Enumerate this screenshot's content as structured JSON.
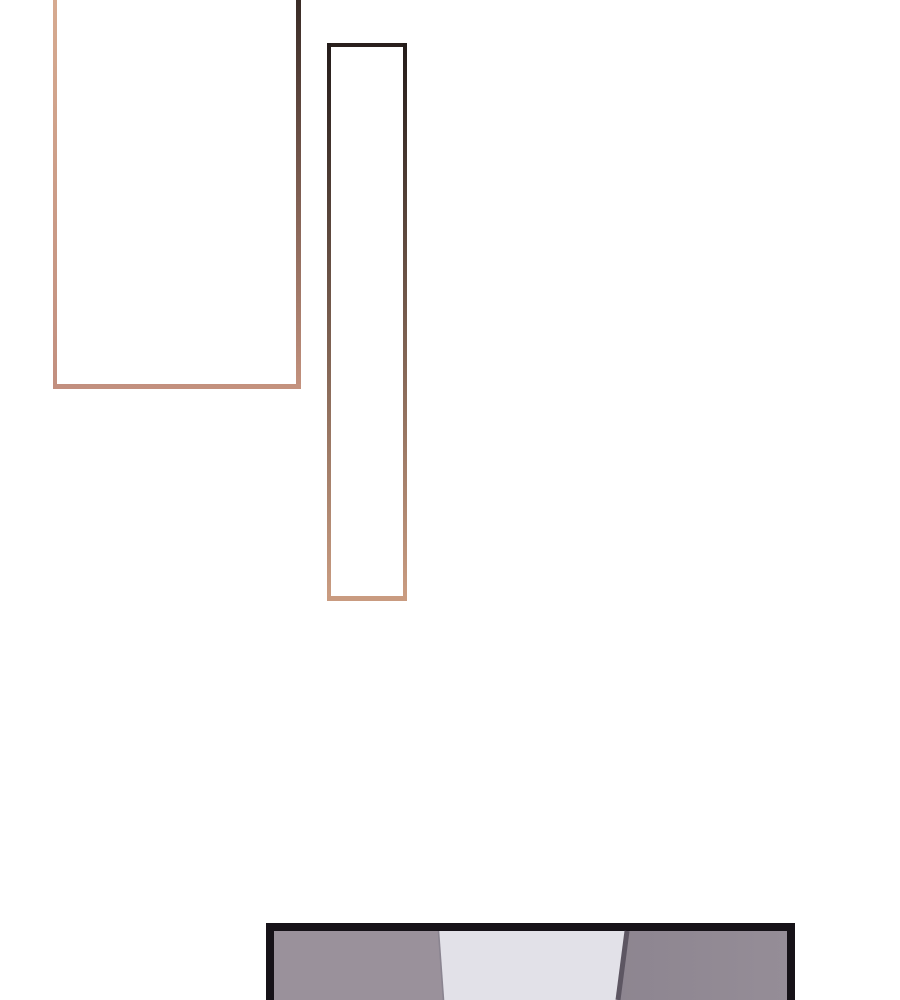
{
  "page": {
    "background": "#ffffff"
  },
  "panel_large": {
    "fill": "#ffffff",
    "border_left_top": "#d6aa90",
    "border_left_bottom": "#c28f7f",
    "border_right_top": "#392b26",
    "border_right_bottom": "#c4927e",
    "border_bottom_start": "#c28f7f",
    "border_bottom_end": "#c4927e"
  },
  "panel_tall": {
    "fill": "#ffffff",
    "border_top": "#2a201d",
    "border_side_top": "#241c1a",
    "border_side_bottom": "#cb9d82",
    "border_bottom": "#c99b80"
  },
  "panel_bottom": {
    "border": "#161218",
    "wall_left": "#9a919b",
    "wall_center": "#e2e1e8",
    "wall_right_near": "#8d8590",
    "wall_right_far": "#958d97",
    "seam_left": "#8a8490",
    "seam_diagonal": "#5d5662"
  }
}
